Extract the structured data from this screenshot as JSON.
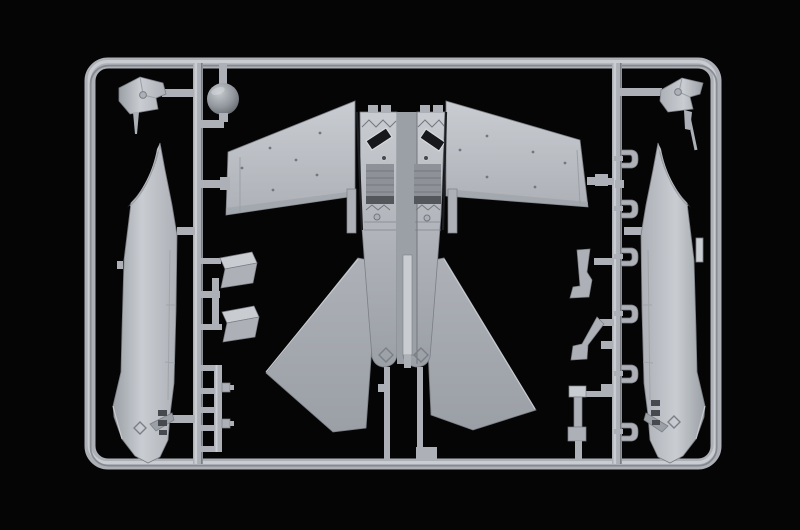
{
  "meta": {
    "description": "Studio photograph of a light gray injection-molded plastic model kit sprue (parts tree) for a twin-engine jet aircraft, shown against a black background. The rectangular runner frame holds the lower fuselage with wings and twin tail fins in the center, left and right fuselage halves on the sides, a spherical nose radome, canopy windscreen pieces, air intake ramps, landing gear struts and small bracket parts.",
    "aria_label": "Gray plastic model aircraft sprue on black background"
  },
  "colors": {
    "bg": "#050506",
    "plastic-base": "#adb1b7",
    "plastic-light": "#c9cdd2",
    "plastic-lighter": "#d8dce0",
    "plastic-mid": "#9ba0a6",
    "plastic-dark": "#7b7f85",
    "plastic-deep": "#53575c",
    "recess": "#8e9298",
    "rib": "#74787e",
    "slot-dark": "#46494e",
    "opening-black": "#17181c",
    "seam-black": "#1c1e22",
    "ball-hi": "#c6cacf",
    "ball-mid": "#90969c",
    "ball-dark": "#585c62"
  },
  "parts": [
    {
      "id": "sprue-frame",
      "label": "rectangular sprue runner frame"
    },
    {
      "id": "runner-left",
      "label": "left vertical runner"
    },
    {
      "id": "runner-right",
      "label": "right vertical runner"
    },
    {
      "id": "center-fuselage-wings",
      "label": "lower fuselage with wings and tail fins"
    },
    {
      "id": "left-wing",
      "label": "left wing panel"
    },
    {
      "id": "right-wing",
      "label": "right wing panel"
    },
    {
      "id": "tail-fin-left",
      "label": "left tail fin"
    },
    {
      "id": "tail-fin-right",
      "label": "right tail fin"
    },
    {
      "id": "fuselage-half-left",
      "label": "left fuselage half"
    },
    {
      "id": "fuselage-half-right",
      "label": "right fuselage half"
    },
    {
      "id": "nose-radome-ball",
      "label": "spherical nose radome"
    },
    {
      "id": "windscreen-left",
      "label": "windscreen / canopy frame part, left"
    },
    {
      "id": "windscreen-right",
      "label": "windscreen / canopy frame part, right"
    },
    {
      "id": "intake-ramp-1",
      "label": "air intake ramp part"
    },
    {
      "id": "intake-ramp-2",
      "label": "air intake ramp part"
    },
    {
      "id": "ladder-small-parts",
      "label": "small pin parts on ladder runner"
    },
    {
      "id": "gear-strut",
      "label": "landing gear strut"
    },
    {
      "id": "gear-leg-brackets",
      "label": "landing gear leg brackets"
    },
    {
      "id": "door-hinge-brackets",
      "label": "gear door hinge brackets"
    }
  ]
}
